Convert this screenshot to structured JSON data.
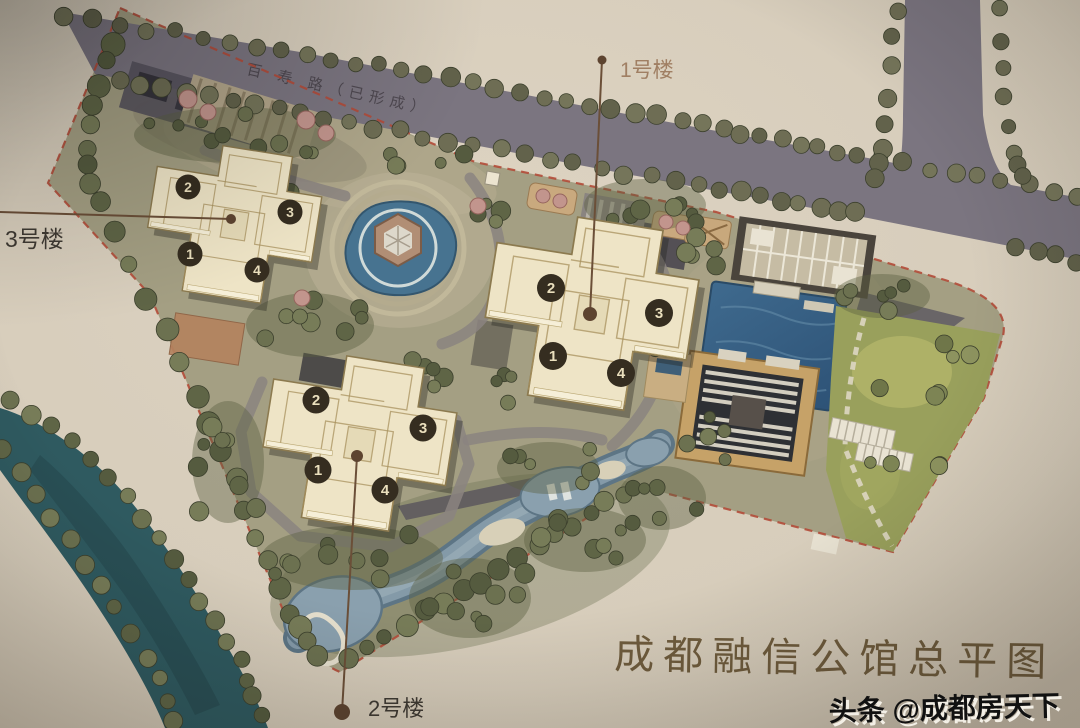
{
  "plan": {
    "title": "成都融信公馆总平图",
    "watermark": "头条 @成都房天下",
    "road_name": "百 寿 路（已形成）"
  },
  "buildings": {
    "b1": {
      "label": "1号楼",
      "units": [
        "1",
        "2",
        "3",
        "4"
      ]
    },
    "b2": {
      "label": "2号楼",
      "units": [
        "1",
        "2",
        "3",
        "4"
      ]
    },
    "b3": {
      "label": "3号楼",
      "units": [
        "1",
        "2",
        "3",
        "4"
      ]
    }
  },
  "colors": {
    "paper": "#d8cebd",
    "road": "#7b7580",
    "boundary_red": "#b34b38",
    "river_teal": "#2f5a60",
    "building_cream": "#eee4c6",
    "pool_blue": "#3a6487",
    "lawn_green": "#99a05c",
    "title_brown": "#6f5c3d",
    "label_brown": "#a07f63",
    "label_dark": "#3f3a33"
  }
}
